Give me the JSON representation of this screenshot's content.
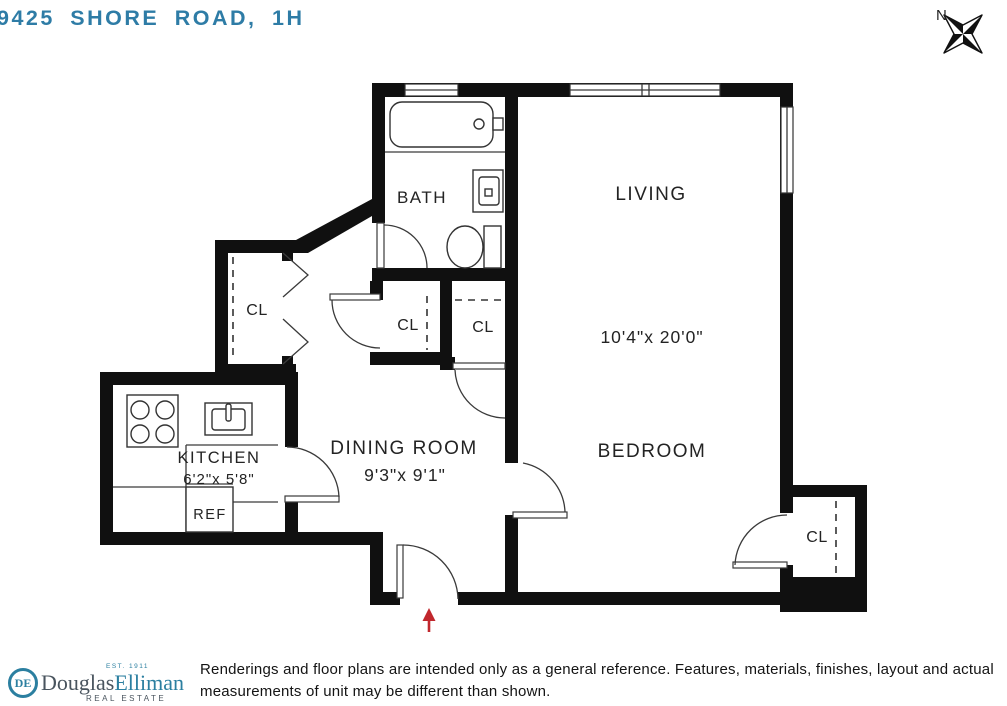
{
  "page": {
    "title": "9425 SHORE ROAD, 1H"
  },
  "compass": {
    "label": "N"
  },
  "colors": {
    "accent_teal": "#2b7fa0",
    "title_teal": "#2e7ca6",
    "wall_black": "#101010",
    "entry_arrow_red": "#c1272d",
    "label_dark": "#232323"
  },
  "floorplan": {
    "rooms": {
      "living": {
        "label": "LIVING",
        "dimensions": "10'4\"x 20'0\""
      },
      "bedroom": {
        "label": "BEDROOM"
      },
      "dining": {
        "label": "DINING ROOM",
        "dimensions": "9'3\"x 9'1\""
      },
      "kitchen": {
        "label": "KITCHEN",
        "dimensions": "6'2\"x 5'8\""
      },
      "bath": {
        "label": "BATH"
      },
      "refrigerator": {
        "label": "REF"
      },
      "closet_hall_left": {
        "label": "CL"
      },
      "closet_hall_center": {
        "label": "CL"
      },
      "closet_hall_right": {
        "label": "CL"
      },
      "closet_bedroom": {
        "label": "CL"
      }
    },
    "fixtures": [
      "bathtub",
      "toilet",
      "bathroom-sink",
      "stove",
      "kitchen-sink",
      "refrigerator"
    ]
  },
  "footer": {
    "brand": {
      "monogram": "DE",
      "name_first": "Douglas",
      "name_second": "Elliman",
      "est": "EST. 1911",
      "tagline": "REAL ESTATE"
    },
    "disclaimer_line1": "Renderings and floor plans are intended only as a general reference. Features, materials, finishes, layout and actual",
    "disclaimer_line2": "measurements of unit may be different than shown."
  }
}
